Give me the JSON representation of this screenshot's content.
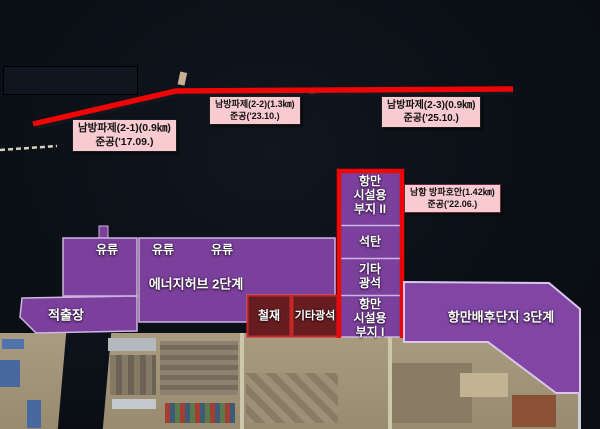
{
  "legend_boxes": [
    {
      "id": "breakwater-2-1",
      "line1": "남방파제(2-1)(0.9㎞)",
      "line2": "준공('17.09.)"
    },
    {
      "id": "breakwater-2-2",
      "line1": "남방파제(2-2)(1.3㎞)",
      "line2": "준공('23.10.)"
    },
    {
      "id": "breakwater-2-3",
      "line1": "남방파제(2-3)(0.9㎞)",
      "line2": "준공('25.10.)"
    },
    {
      "id": "namhang-revetment",
      "line1": "남항 방파호안(1.42㎞)",
      "line2": "준공('22.06.)"
    }
  ],
  "zones": {
    "oil_labels": [
      "유류",
      "유류",
      "유류"
    ],
    "energy_hub": "에너지허브 2단계",
    "extraction_yard": "적출장",
    "steel": "철재",
    "other_ore_small": "기타광석",
    "port_facility_2": [
      "항만",
      "시설용",
      "부지 II"
    ],
    "coal": "석탄",
    "other_ore": [
      "기타",
      "광석"
    ],
    "port_facility_1": [
      "항만",
      "시설용",
      "부지 I"
    ],
    "hinterland_3": "항만배후단지 3단계"
  },
  "colors": {
    "zone_purple": "#7b3f9c",
    "zone_purple_light": "#8145a3",
    "zone_maroon": "#671c20",
    "zone_maroon_border": "#c62828",
    "highlight_red": "#ee0505",
    "label_pink": "#f8cbd0"
  }
}
